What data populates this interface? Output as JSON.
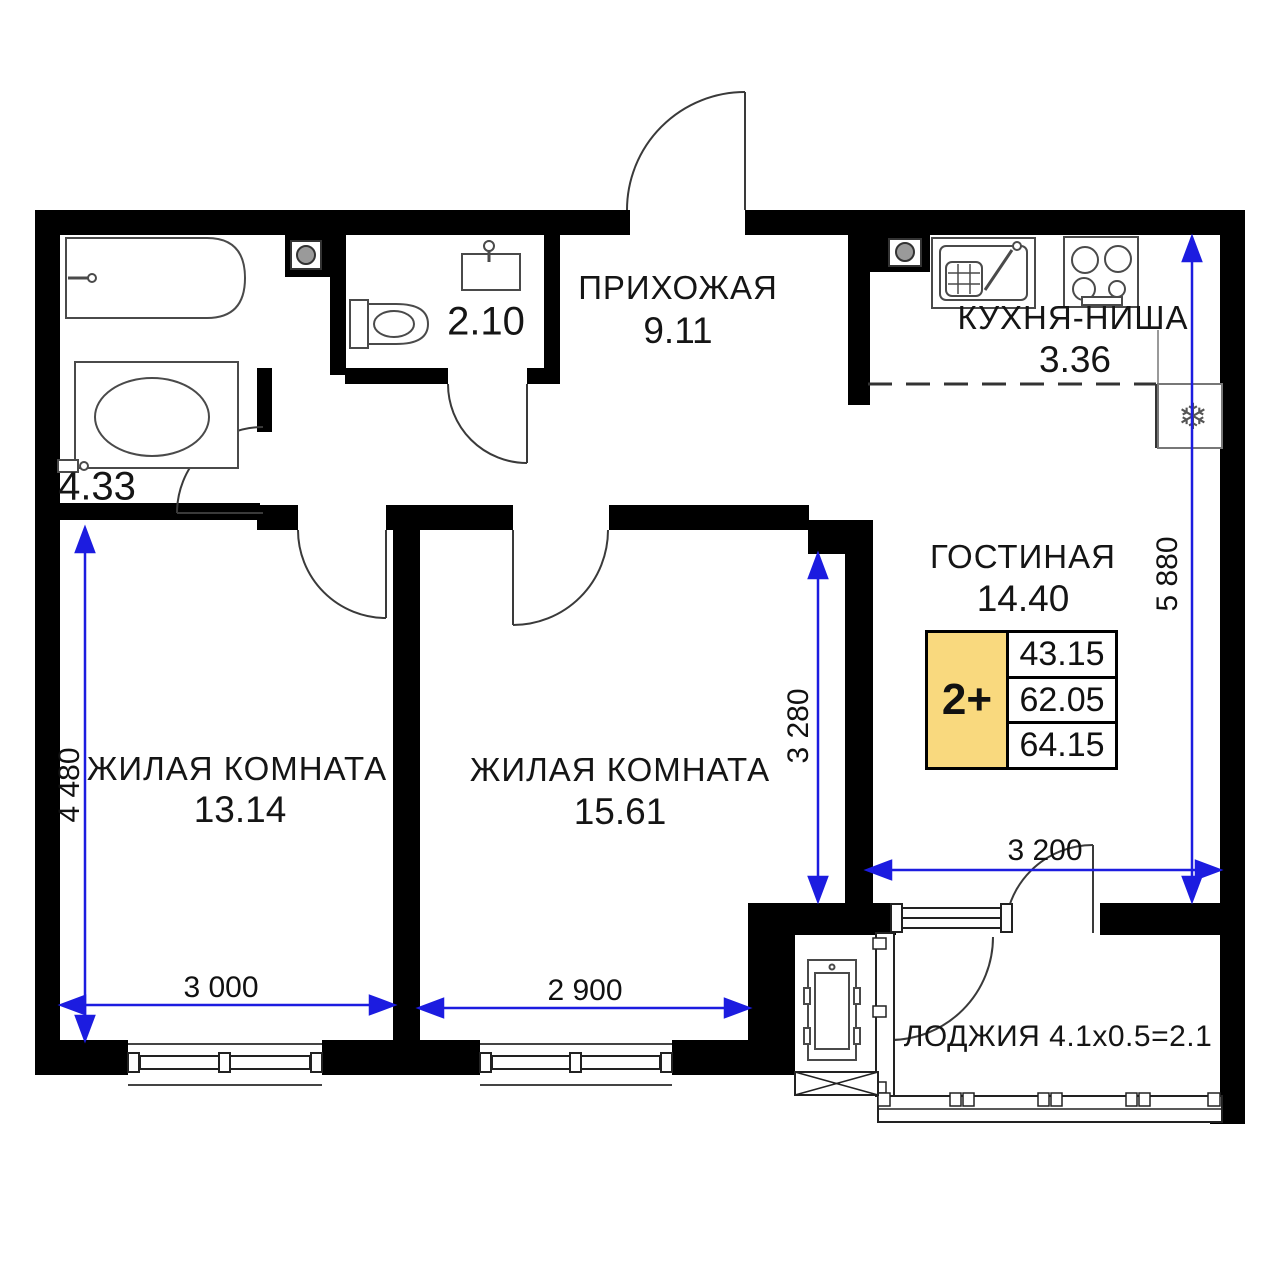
{
  "palette": {
    "background": "#ffffff",
    "walls": "#000000",
    "dimension_blue": "#1c1ce0",
    "card_yellow": "#f9d97e",
    "fixture_gray": "#4a4a4a"
  },
  "rooms": {
    "hallway": {
      "name": "ПРИХОЖАЯ",
      "area": "9.11"
    },
    "kitchen_niche": {
      "name": "КУХНЯ-НИША",
      "area": "3.36"
    },
    "living_room": {
      "name": "ГОСТИНАЯ",
      "area": "14.40"
    },
    "bedroom_left": {
      "name": "ЖИЛАЯ КОМНАТА",
      "area": "13.14"
    },
    "bedroom_middle": {
      "name": "ЖИЛАЯ КОМНАТА",
      "area": "15.61"
    },
    "bathroom": {
      "area": "4.33"
    },
    "wc": {
      "area": "2.10"
    },
    "loggia": {
      "name": "ЛОДЖИЯ",
      "formula": "4.1x0.5=2.1"
    }
  },
  "apartment_card": {
    "type_label": "2+",
    "values": [
      "43.15",
      "62.05",
      "64.15"
    ]
  },
  "dimensions_mm": {
    "bedroom_left_height": "4 480",
    "bedroom_left_width": "3 000",
    "bedroom_middle_width": "2 900",
    "living_depth": "3 280",
    "living_width": "3 200",
    "right_side_height": "5 880"
  },
  "icons": {
    "snowflake": "❄"
  }
}
